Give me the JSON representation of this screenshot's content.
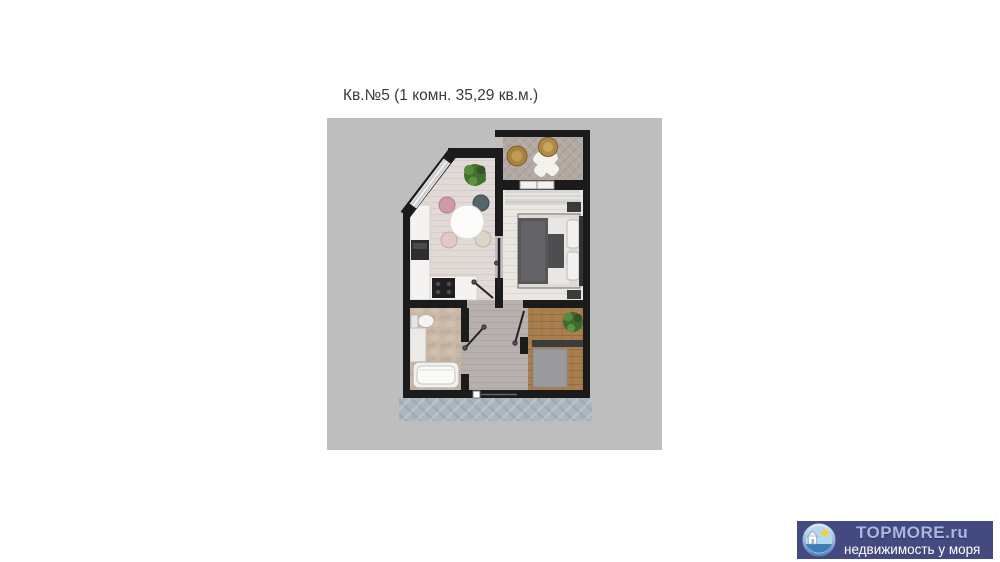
{
  "plan": {
    "title": "Кв.№5 (1 комн. 35,29 кв.м.)",
    "apartment_number": "5",
    "rooms_count": "1",
    "area_sqm": "35,29"
  },
  "floorplan": {
    "rooms": [
      "balcony",
      "bedroom",
      "kitchen-dining",
      "bathroom",
      "hallway",
      "entry"
    ],
    "colors": {
      "canvas_bg": "#bfbebe",
      "walls": "#1b1b1b",
      "bedroom_floor": "#eae6e1",
      "kitchen_floor": "#e1dad7",
      "hallway_floor": "#b7b0ae",
      "bathroom_floor": "#c9b7a7",
      "entry_wood": "#a97f4f",
      "balcony_floor": "#b1a9a2",
      "corridor_tile": "#adb6be"
    }
  },
  "logo": {
    "brand": "TOPMORE.ru",
    "tagline": "недвижимость у моря",
    "bg_color": "#444a80",
    "brand_color": "#a9b7e2",
    "tagline_color": "#ffffff"
  }
}
